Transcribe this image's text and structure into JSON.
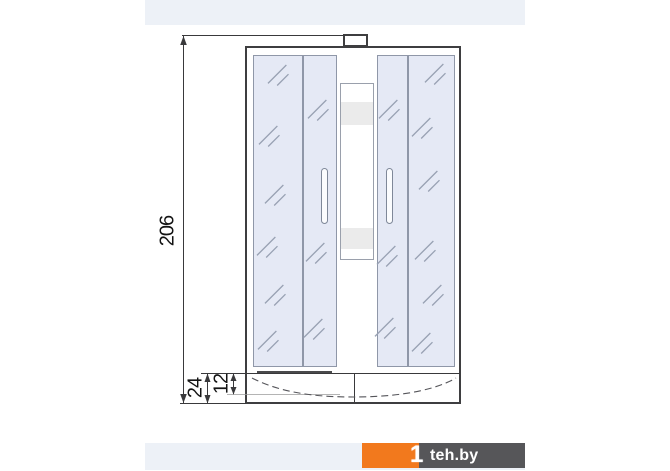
{
  "drawing": {
    "subject": "shower cabin front elevation",
    "dimensions": {
      "overall_height": "206",
      "tray_height": "24",
      "tray_basin_depth": "12"
    }
  },
  "colors": {
    "strip": "#edf1f7",
    "outline": "#3e3e40",
    "glass_fill": "#e5e9f5",
    "glass_border": "#8f97a8",
    "hatch": "#98a1b3",
    "band": "#ebebeb",
    "dim": "#39393b"
  },
  "watermark": {
    "digit": "1",
    "text": "teh.by",
    "orange": "#f2791d",
    "dark": "#565659"
  }
}
